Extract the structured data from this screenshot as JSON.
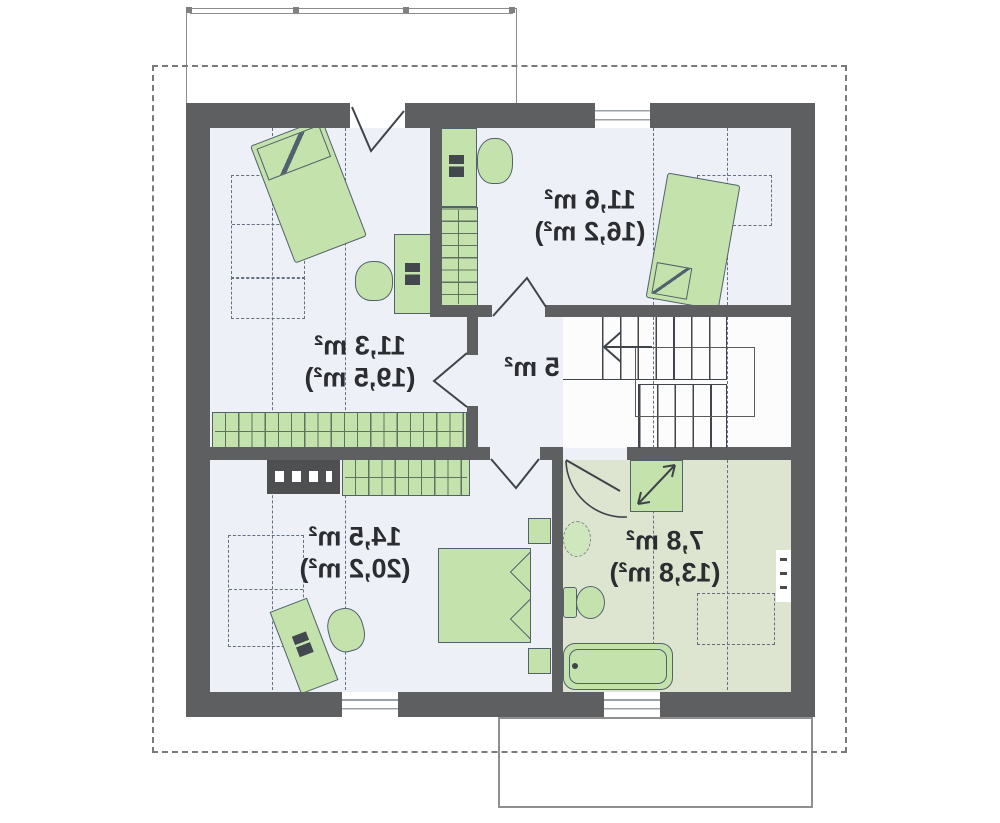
{
  "floor_plan": {
    "type": "attic-storey-plan",
    "text_mirrored": true,
    "rooms": [
      {
        "name": "bedroom-top-left",
        "area": "11,3 m²",
        "area_with_slopes": "(19,5 m²)"
      },
      {
        "name": "bedroom-top-right",
        "area": "11,6 m²",
        "area_with_slopes": "(16,2 m²)"
      },
      {
        "name": "hall",
        "area": "5 m²",
        "area_with_slopes": ""
      },
      {
        "name": "bedroom-bottom-left",
        "area": "14,5 m²",
        "area_with_slopes": "(20,2 m²)"
      },
      {
        "name": "bathroom",
        "area": "7,8 m²",
        "area_with_slopes": "(13,8 m²)"
      }
    ],
    "colors": {
      "wall": "#5e5f60",
      "furniture_fill": "#c4e3ac",
      "furniture_border": "#51616e",
      "floor_room": "#edf0f7",
      "floor_bathroom": "#dde5d0",
      "dashed_guides": "#64707f",
      "roof_outline": "#7a7a7a"
    }
  }
}
